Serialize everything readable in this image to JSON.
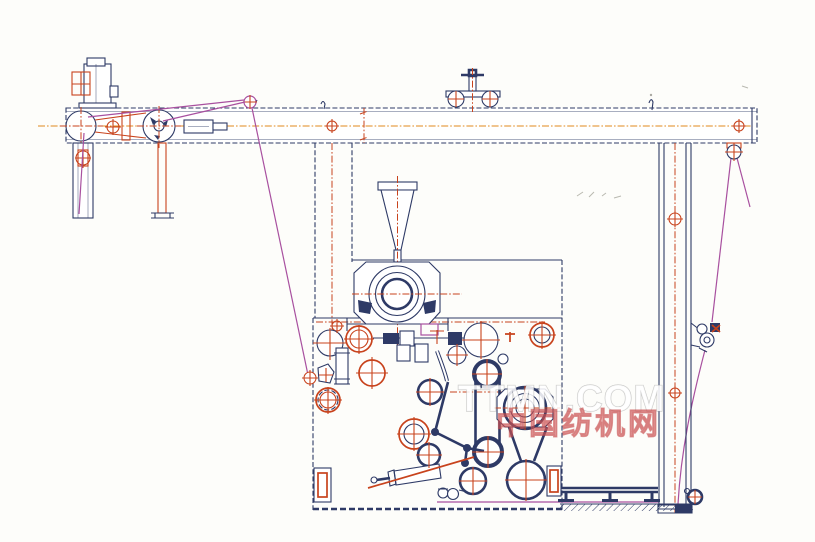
{
  "watermark": {
    "latin": "TTMN.COM",
    "chinese": "中国纺机网"
  },
  "palette": {
    "line_navy": "#2e3a66",
    "line_red": "#c8431d",
    "line_orange": "#e0891e",
    "line_magenta": "#a8509f",
    "bg": "#fdfdfa",
    "watermark_red": "#cc5a5a"
  }
}
